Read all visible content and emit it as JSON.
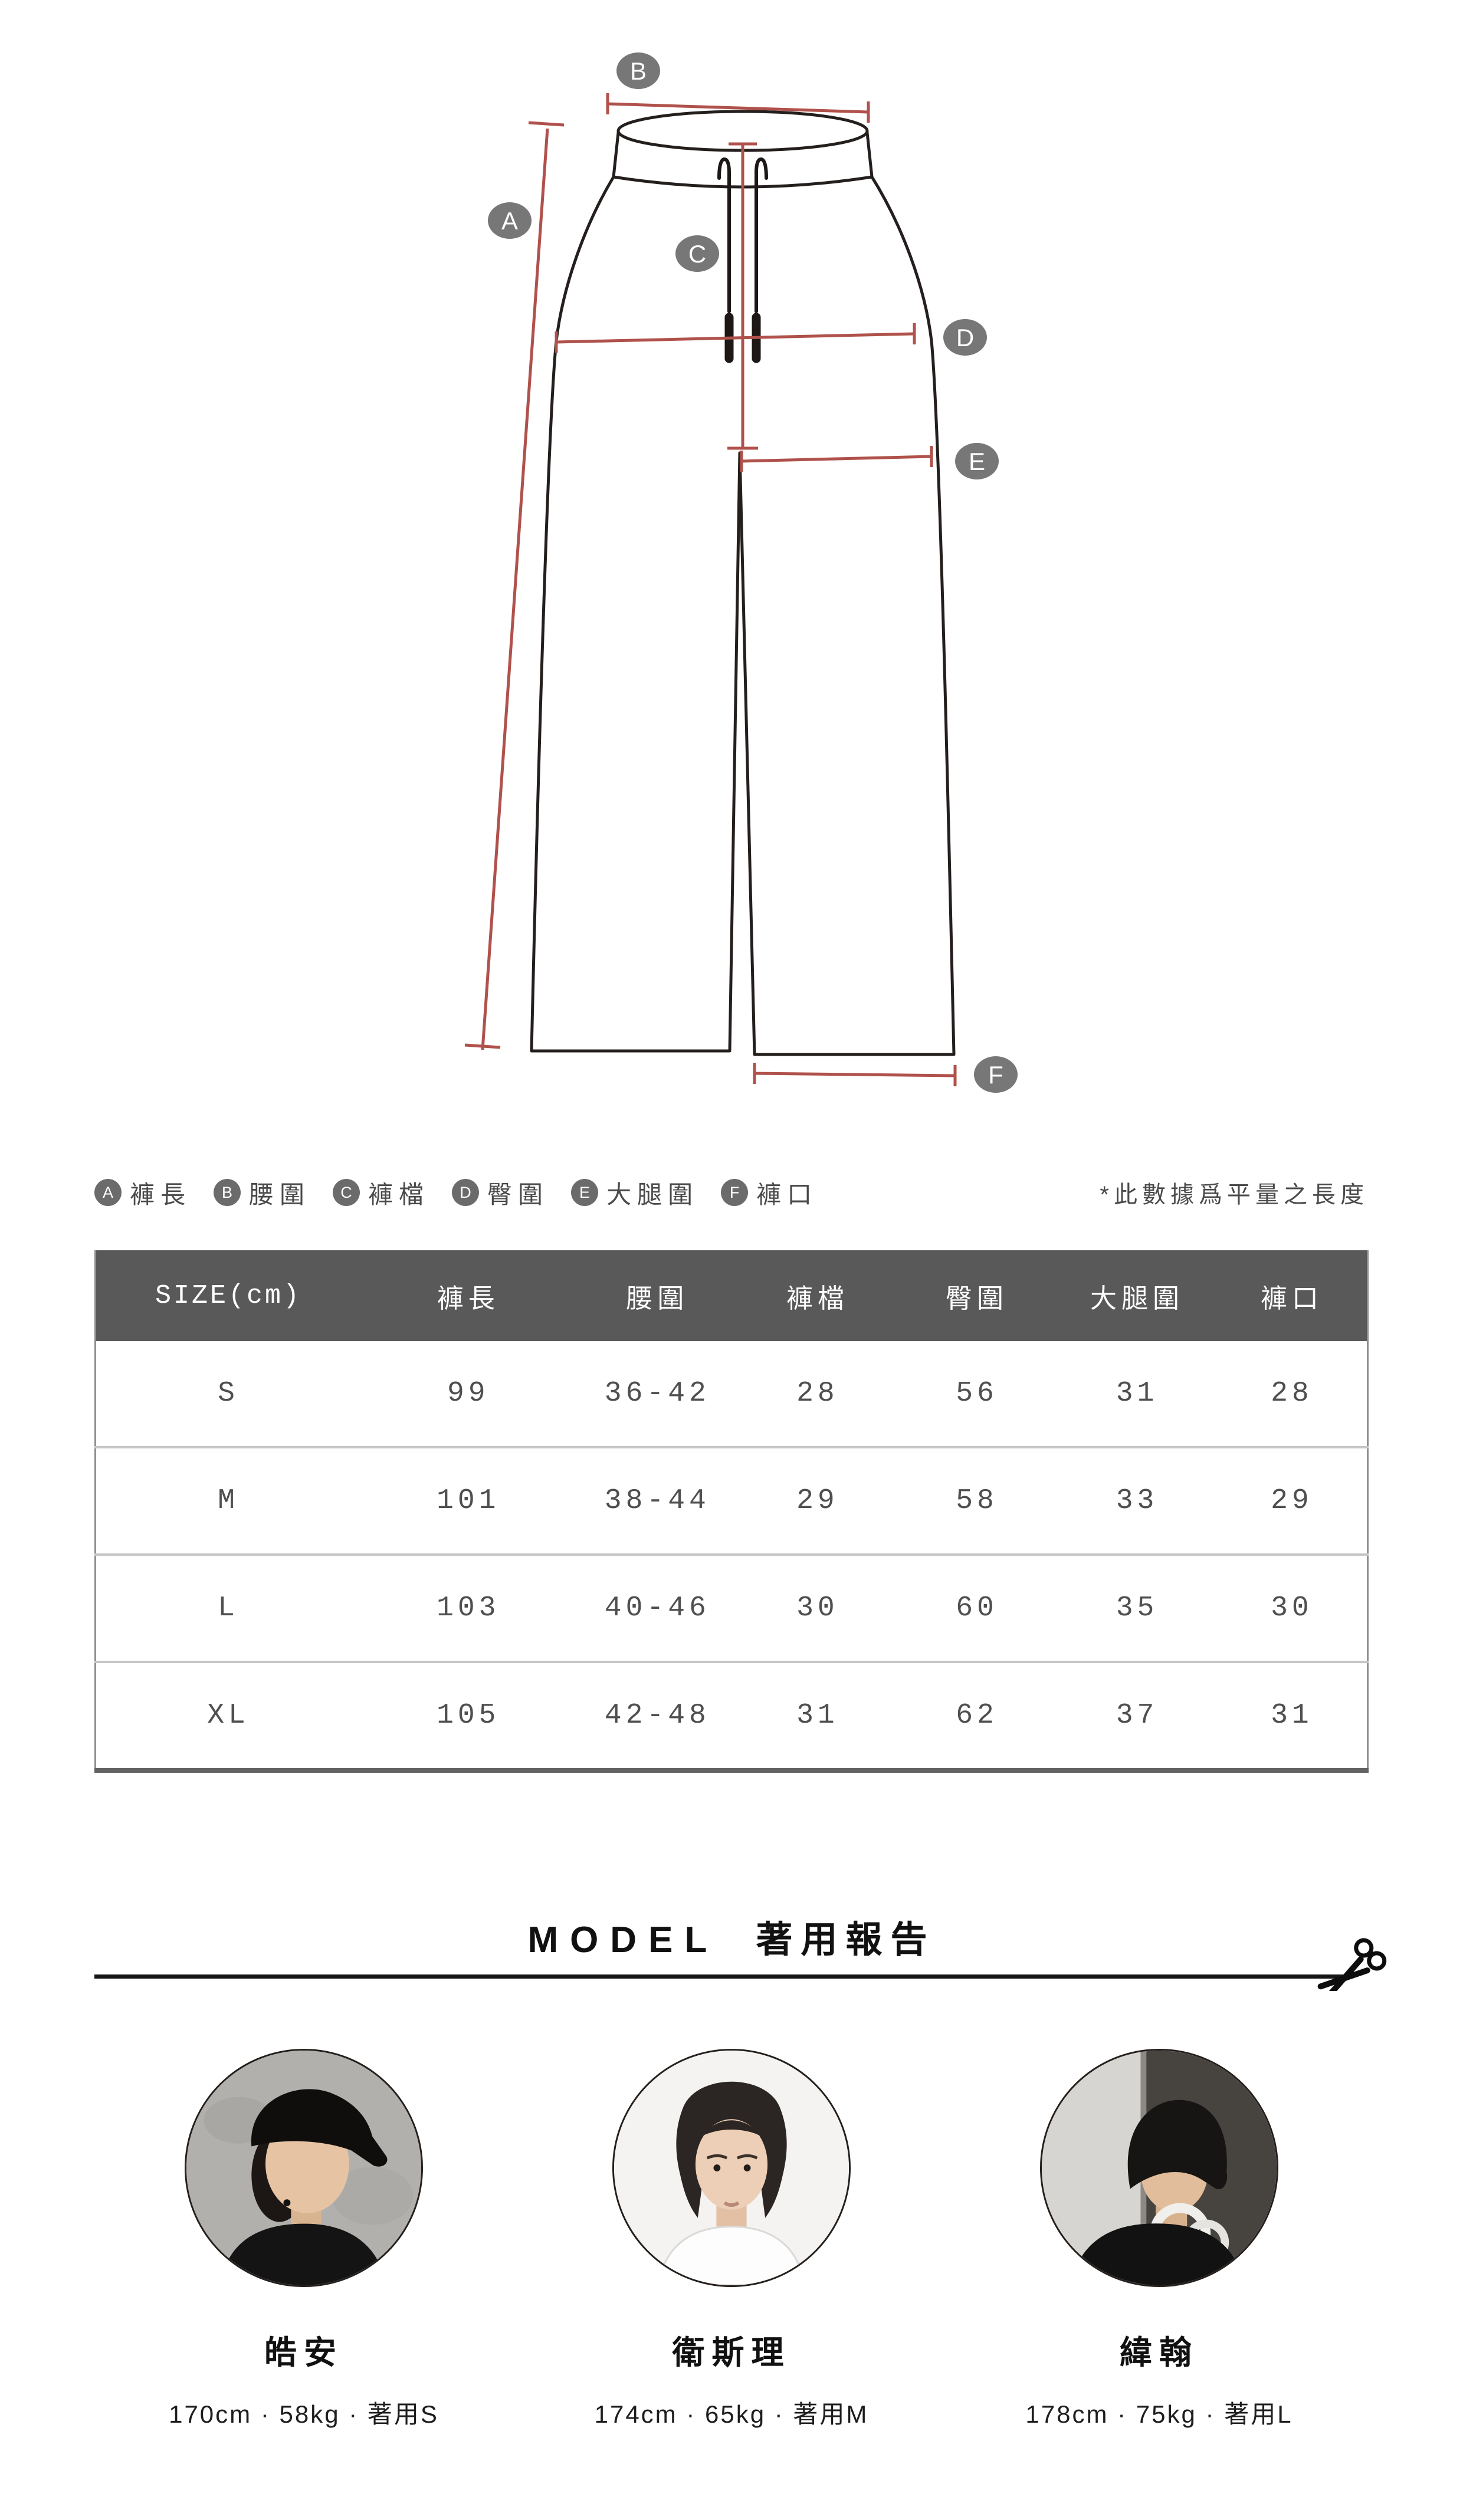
{
  "legend": {
    "items": [
      {
        "letter": "A",
        "label": "褲長"
      },
      {
        "letter": "B",
        "label": "腰圍"
      },
      {
        "letter": "C",
        "label": "褲檔"
      },
      {
        "letter": "D",
        "label": "臀圍"
      },
      {
        "letter": "E",
        "label": "大腿圍"
      },
      {
        "letter": "F",
        "label": "褲口"
      }
    ],
    "note": "*此數據爲平量之長度"
  },
  "size_table": {
    "headers": [
      "SIZE(cm)",
      "褲長",
      "腰圍",
      "褲檔",
      "臀圍",
      "大腿圍",
      "褲口"
    ],
    "rows": [
      {
        "size": "S",
        "values": [
          "99",
          "36-42",
          "28",
          "56",
          "31",
          "28"
        ]
      },
      {
        "size": "M",
        "values": [
          "101",
          "38-44",
          "29",
          "58",
          "33",
          "29"
        ]
      },
      {
        "size": "L",
        "values": [
          "103",
          "40-46",
          "30",
          "60",
          "35",
          "30"
        ]
      },
      {
        "size": "XL",
        "values": [
          "105",
          "42-48",
          "31",
          "62",
          "37",
          "31"
        ]
      }
    ]
  },
  "model_section": {
    "title_en": "MODEL",
    "title_zh": "著用報告"
  },
  "models": [
    {
      "name": "皓安",
      "stats": "170cm · 58kg · 著用S"
    },
    {
      "name": "衛斯理",
      "stats": "174cm · 65kg · 著用M"
    },
    {
      "name": "緯翰",
      "stats": "178cm · 75kg · 著用L"
    }
  ],
  "colors": {
    "measure_line": "#b0514b",
    "label_bubble": "#777777",
    "table_header_bg": "#595959"
  }
}
